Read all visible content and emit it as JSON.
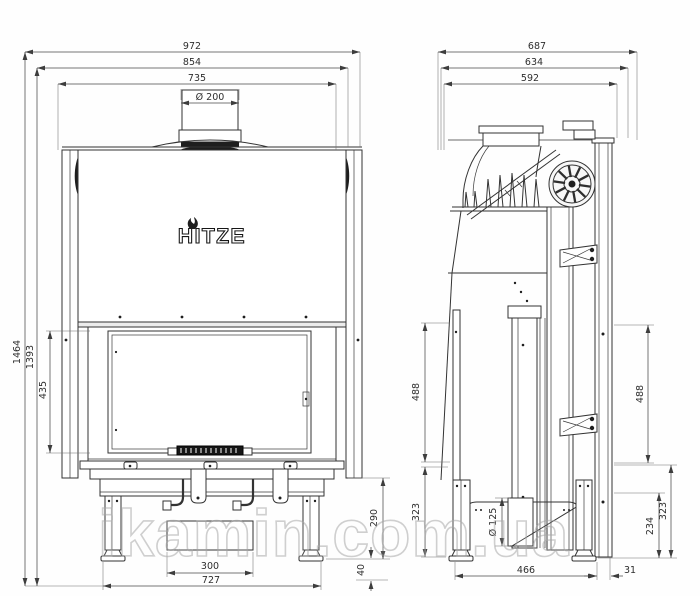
{
  "watermark": {
    "text": "ikamin.com.ua"
  },
  "logo": {
    "text": "HITZE"
  },
  "front_view": {
    "dims": {
      "w972": "972",
      "w854": "854",
      "w735": "735",
      "flue": "Ø 200",
      "h1464": "1464",
      "h1393": "1393",
      "h435": "435",
      "w300": "300",
      "w727": "727",
      "h290": "290",
      "h40": "40"
    }
  },
  "side_view": {
    "dims": {
      "d687": "687",
      "d634": "634",
      "d592": "592",
      "h488": "488",
      "h323": "323",
      "h234": "234",
      "outlet": "Ø 125",
      "d466": "466",
      "d31": "31"
    }
  }
}
